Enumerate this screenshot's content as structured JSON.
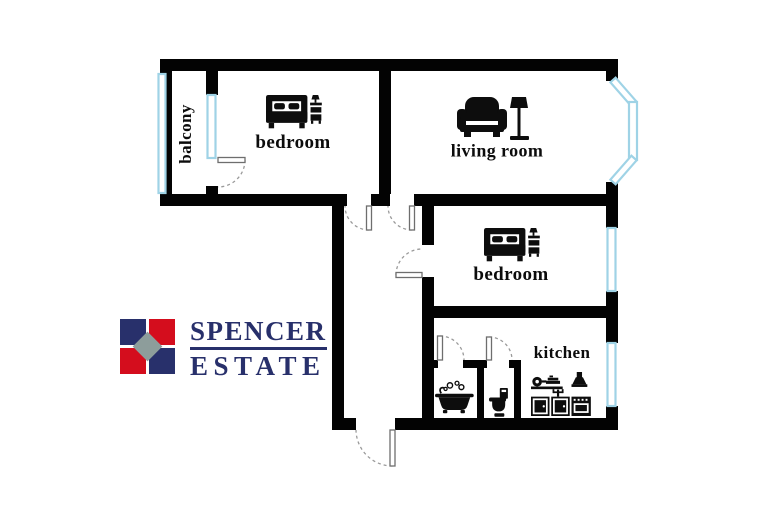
{
  "plan": {
    "rooms": [
      {
        "id": "balcony",
        "label": "balcony"
      },
      {
        "id": "bedroom-top",
        "label": "bedroom"
      },
      {
        "id": "living-room",
        "label": "living room"
      },
      {
        "id": "bedroom-right",
        "label": "bedroom"
      },
      {
        "id": "kitchen",
        "label": "kitchen"
      }
    ],
    "unlabeled_rooms": [
      "hallway",
      "bathroom",
      "toilet"
    ],
    "icons": [
      {
        "room": "bedroom-top",
        "name": "double-bed-with-nightstand-icon"
      },
      {
        "room": "living-room",
        "name": "armchair-with-floor-lamp-icon"
      },
      {
        "room": "bedroom-right",
        "name": "double-bed-with-nightstand-icon"
      },
      {
        "room": "bathroom",
        "name": "bathtub-icon"
      },
      {
        "room": "toilet",
        "name": "toilet-icon"
      },
      {
        "room": "kitchen",
        "name": "kitchen-appliances-icon"
      }
    ],
    "window_count": 7,
    "door_count": 7
  },
  "logo": {
    "line1": "SPENCER",
    "line2": "ESTATE",
    "colors": {
      "navy": "#28306b",
      "red": "#d40d1d",
      "gray": "#8d9d9b"
    }
  },
  "colors": {
    "wall": "#030303",
    "window_frame": "#9fd3e6",
    "background": "#ffffff",
    "door_arc": "#9a9a9a"
  }
}
